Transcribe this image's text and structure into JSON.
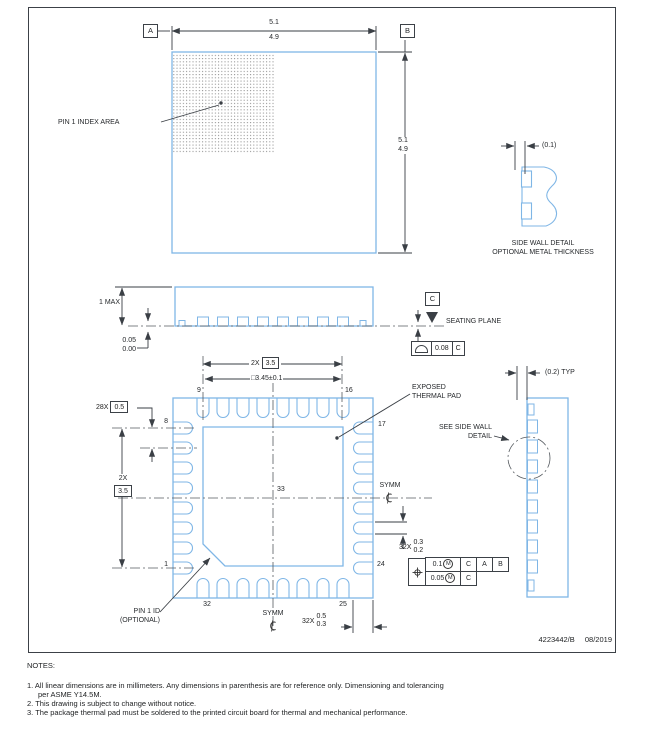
{
  "drawing": {
    "doc_number": "4223442/B",
    "date": "08/2019"
  },
  "notes": {
    "heading": "NOTES:",
    "note1_line1": "1. All linear dimensions are in millimeters. Any dimensions in parenthesis are for reference only. Dimensioning and tolerancing",
    "note1_line2": "per ASME Y14.5M.",
    "note2": "2. This drawing is subject to change without notice.",
    "note3": "3. The package thermal pad must be soldered to the printed circuit board for thermal and mechanical performance."
  },
  "top_view": {
    "datum_a": "A",
    "datum_b": "B",
    "width_max": "5.1",
    "width_min": "4.9",
    "height_max": "5.1",
    "height_min": "4.9",
    "pin1_index_label": "PIN 1 INDEX AREA"
  },
  "side_wall_detail": {
    "thickness_dim": "(0.1)",
    "title": "SIDE WALL DETAIL",
    "subtitle": "OPTIONAL METAL THICKNESS"
  },
  "side_view": {
    "height_dim": "1 MAX",
    "standoff_max": "0.05",
    "standoff_min": "0.00",
    "datum_c": "C",
    "seating_plane_label": "SEATING PLANE",
    "flatness_value": "0.08",
    "flatness_datum": "C"
  },
  "bottom_view": {
    "pitch_count": "28X",
    "pitch_value": "0.5",
    "span_count": "2X",
    "span_value": "3.5",
    "pad_dim": "□3.45±0.1",
    "pad_label_line1": "EXPOSED",
    "pad_label_line2": "THERMAL PAD",
    "see_detail_line1": "SEE SIDE WALL",
    "see_detail_line2": "DETAIL",
    "symm": "SYMM",
    "pin_numbers": {
      "p1": "1",
      "p8": "8",
      "p9": "9",
      "p16": "16",
      "p17": "17",
      "p24": "24",
      "p25": "25",
      "p32": "32",
      "p33": "33"
    },
    "lead_width_count": "32X",
    "lead_width_max": "0.3",
    "lead_width_min": "0.2",
    "lead_length_count": "32X",
    "lead_length_max": "0.5",
    "lead_length_min": "0.3",
    "pin1_id_line1": "PIN 1 ID",
    "pin1_id_line2": "(OPTIONAL)",
    "tolerance": {
      "pos_value": "0.1",
      "pos_mod": "M",
      "pos_datums": [
        "C",
        "A",
        "B"
      ],
      "pos2_value": "0.05",
      "pos2_mod": "M",
      "pos2_datum": "C"
    }
  },
  "right_side_view": {
    "typ_dim": "(0.2) TYP"
  }
}
